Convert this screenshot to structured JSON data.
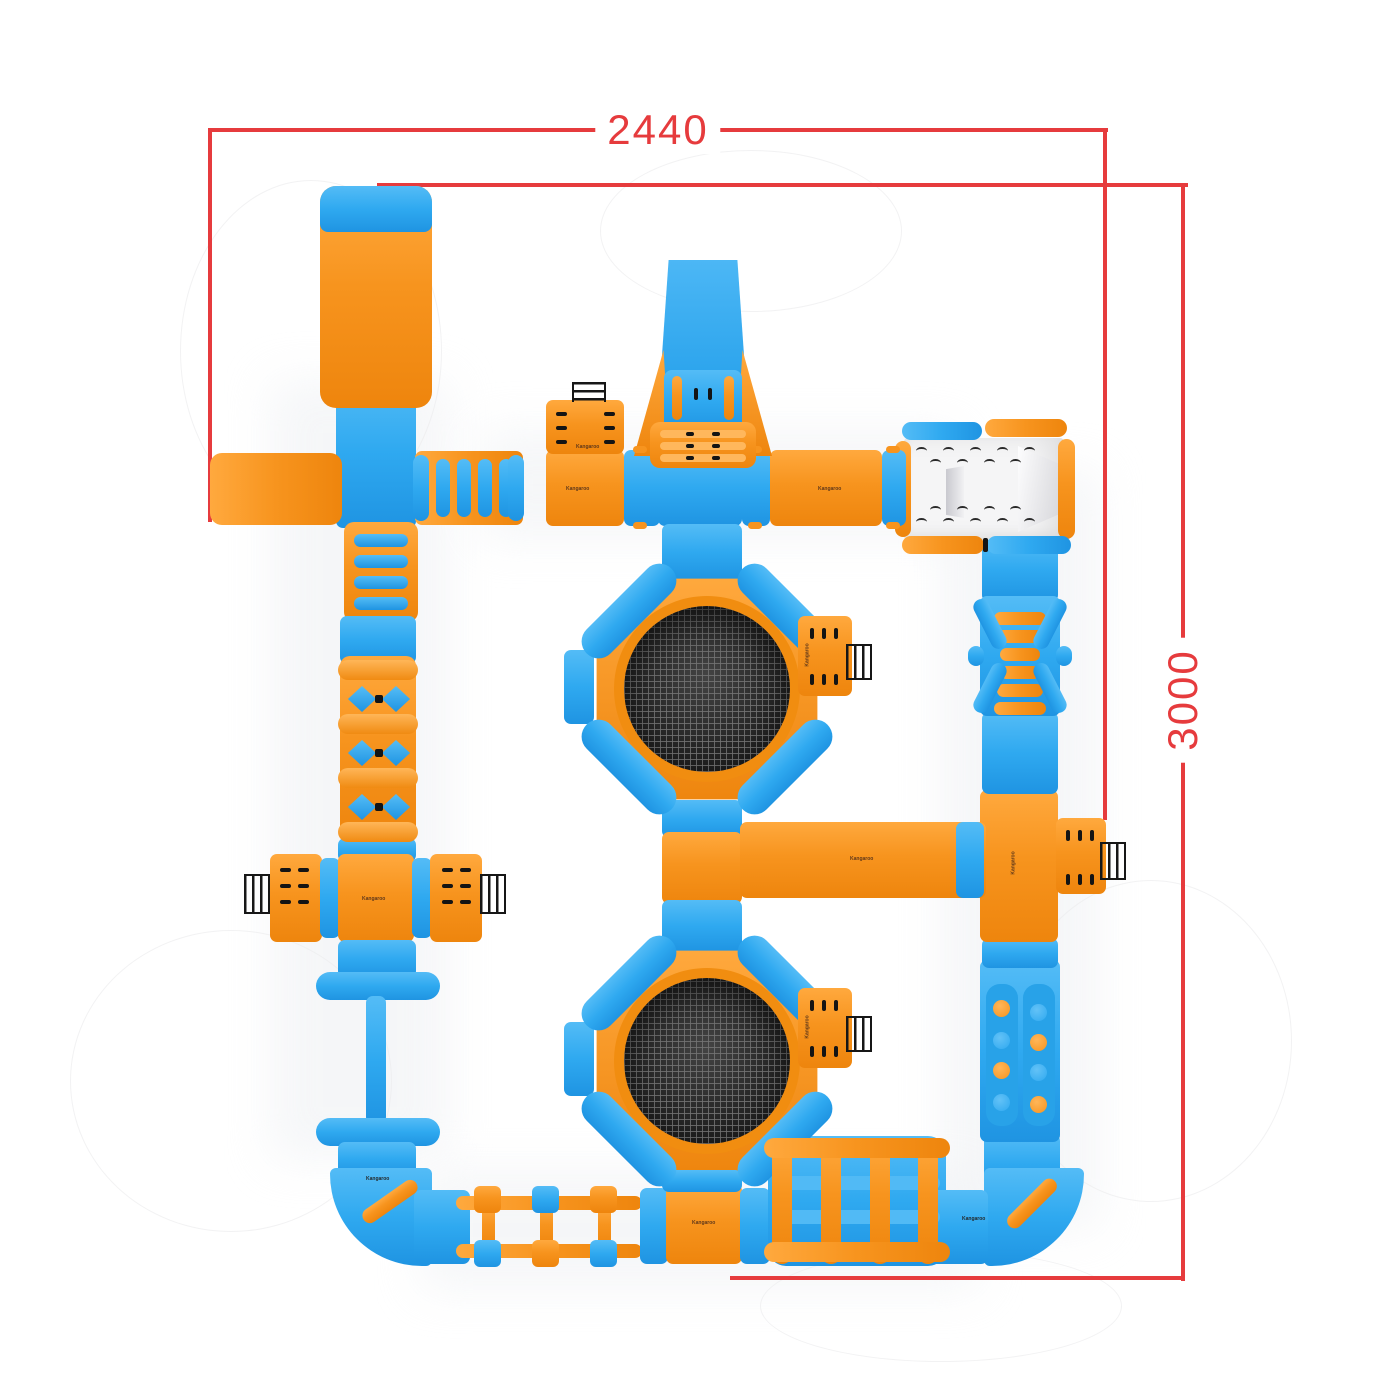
{
  "dimensions": {
    "width": "2440",
    "height": "3000"
  },
  "brand": {
    "logo_text": "Kangaroo"
  },
  "colors": {
    "blue": "#2FA9F0",
    "orange": "#F7941E",
    "dimension_red": "#E63B3D",
    "mesh_dark": "#262626",
    "platform_white": "#F5F5F6"
  }
}
